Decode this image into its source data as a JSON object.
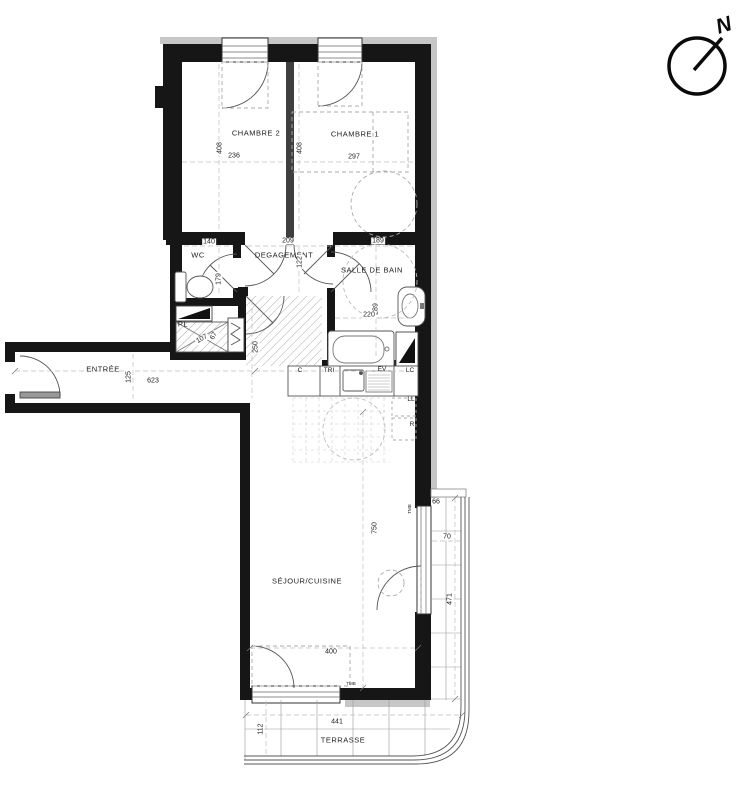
{
  "compass": {
    "label": "N"
  },
  "rooms": [
    {
      "label": "CHAMBRE 2",
      "x": 256,
      "y": 133,
      "rot": 0
    },
    {
      "label": "CHAMBRE 1",
      "x": 355,
      "y": 134,
      "rot": 0
    },
    {
      "label": "WC",
      "x": 198,
      "y": 255,
      "rot": 0
    },
    {
      "label": "DEGAGEMENT",
      "x": 284,
      "y": 255,
      "rot": 0
    },
    {
      "label": "SALLE DE BAIN",
      "x": 372,
      "y": 270,
      "rot": 0
    },
    {
      "label": "PL",
      "x": 183,
      "y": 324,
      "rot": 0
    },
    {
      "label": "ENTRÉE",
      "x": 103,
      "y": 369,
      "rot": 0
    },
    {
      "label": "SÉJOUR/CUISINE",
      "x": 307,
      "y": 581,
      "rot": 0
    },
    {
      "label": "TERRASSE",
      "x": 343,
      "y": 740,
      "rot": 0
    }
  ],
  "dimensions": [
    {
      "text": "408",
      "x": 220,
      "y": 148,
      "rot": -90
    },
    {
      "text": "236",
      "x": 234,
      "y": 156,
      "rot": 0
    },
    {
      "text": "408",
      "x": 300,
      "y": 148,
      "rot": -90
    },
    {
      "text": "297",
      "x": 354,
      "y": 157,
      "rot": 0
    },
    {
      "text": "140",
      "x": 209,
      "y": 242,
      "rot": 0
    },
    {
      "text": "209",
      "x": 288,
      "y": 241,
      "rot": 0
    },
    {
      "text": "189",
      "x": 378,
      "y": 241,
      "rot": 0
    },
    {
      "text": "179",
      "x": 219,
      "y": 279,
      "rot": -90
    },
    {
      "text": "122",
      "x": 300,
      "y": 262,
      "rot": -90
    },
    {
      "text": "289",
      "x": 376,
      "y": 309,
      "rot": -90
    },
    {
      "text": "220",
      "x": 369,
      "y": 315,
      "rot": 0
    },
    {
      "text": "107",
      "x": 202,
      "y": 339,
      "rot": -30
    },
    {
      "text": "67",
      "x": 214,
      "y": 336,
      "rot": -60
    },
    {
      "text": "250",
      "x": 256,
      "y": 347,
      "rot": -90
    },
    {
      "text": "125",
      "x": 129,
      "y": 377,
      "rot": -90
    },
    {
      "text": "623",
      "x": 153,
      "y": 381,
      "rot": 0
    },
    {
      "text": "750",
      "x": 375,
      "y": 528,
      "rot": -90
    },
    {
      "text": "400",
      "x": 331,
      "y": 652,
      "rot": 0
    },
    {
      "text": "66",
      "x": 436,
      "y": 502,
      "rot": 0
    },
    {
      "text": "70",
      "x": 447,
      "y": 537,
      "rot": 0
    },
    {
      "text": "471",
      "x": 450,
      "y": 599,
      "rot": -90
    },
    {
      "text": "441",
      "x": 337,
      "y": 722,
      "rot": 0
    },
    {
      "text": "112",
      "x": 261,
      "y": 729,
      "rot": -90
    }
  ],
  "appliance_labels": [
    {
      "text": "C",
      "x": 300,
      "y": 371,
      "rot": 0
    },
    {
      "text": "TRI",
      "x": 329,
      "y": 371,
      "rot": 0
    },
    {
      "text": "EV",
      "x": 382,
      "y": 370,
      "rot": 0
    },
    {
      "text": "LC",
      "x": 410,
      "y": 371,
      "rot": 0
    },
    {
      "text": "LL",
      "x": 411,
      "y": 400,
      "rot": 0
    },
    {
      "text": "R",
      "x": 412,
      "y": 425,
      "rot": 0
    }
  ],
  "micro_labels": [
    {
      "text": "TMB",
      "x": 351,
      "y": 684,
      "rot": 0
    },
    {
      "text": "TMB",
      "x": 410,
      "y": 509,
      "rot": -90
    }
  ],
  "colors": {
    "wall": "#161616",
    "partition": "#3f3f3f",
    "insulation_band": "#c6c6c6",
    "thin_line": "#555555",
    "dashed_line": "#bdbdbd",
    "hatch": "#aaaaaa"
  }
}
